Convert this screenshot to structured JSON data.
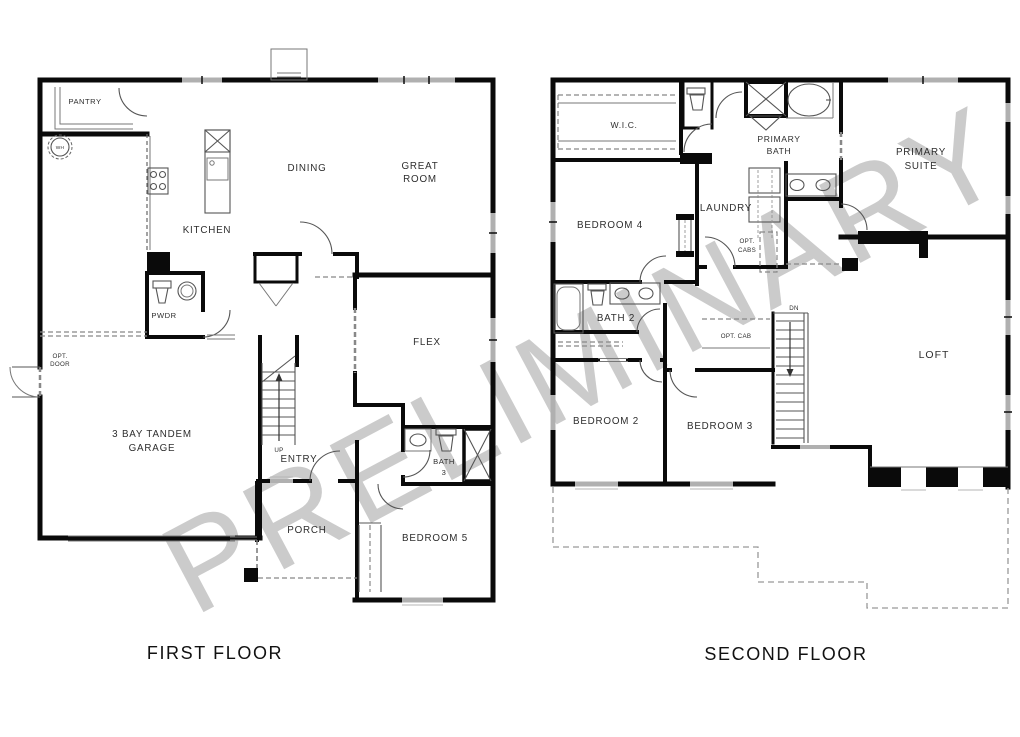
{
  "watermark": "PRELIMINARY",
  "first_floor": {
    "title": "FIRST FLOOR",
    "labels": {
      "pantry": "PANTRY",
      "wh": "WH",
      "kitchen": "KITCHEN",
      "dining": "DINING",
      "great_room_line1": "GREAT",
      "great_room_line2": "ROOM",
      "pwdr": "PWDR",
      "opt_door_line1": "OPT.",
      "opt_door_line2": "DOOR",
      "garage_line1": "3 BAY TANDEM",
      "garage_line2": "GARAGE",
      "up": "UP",
      "entry": "ENTRY",
      "flex": "FLEX",
      "bath3_line1": "BATH",
      "bath3_line2": "3",
      "porch": "PORCH",
      "bedroom5": "BEDROOM 5"
    }
  },
  "second_floor": {
    "title": "SECOND FLOOR",
    "labels": {
      "wic": "W.I.C.",
      "primary_bath_line1": "PRIMARY",
      "primary_bath_line2": "BATH",
      "primary_suite_line1": "PRIMARY",
      "primary_suite_line2": "SUITE",
      "bedroom4": "BEDROOM 4",
      "laundry": "LAUNDRY",
      "opt_cabs_line1": "OPT.",
      "opt_cabs_line2": "CABS",
      "bath2": "BATH 2",
      "opt_cab": "OPT. CAB",
      "dn": "DN",
      "loft": "LOFT",
      "bedroom2": "BEDROOM 2",
      "bedroom3": "BEDROOM 3"
    }
  },
  "colors": {
    "wall": "#0a0a0a",
    "window_gray": "#b0b0b0",
    "watermark_gray": "#cbcbcb"
  }
}
